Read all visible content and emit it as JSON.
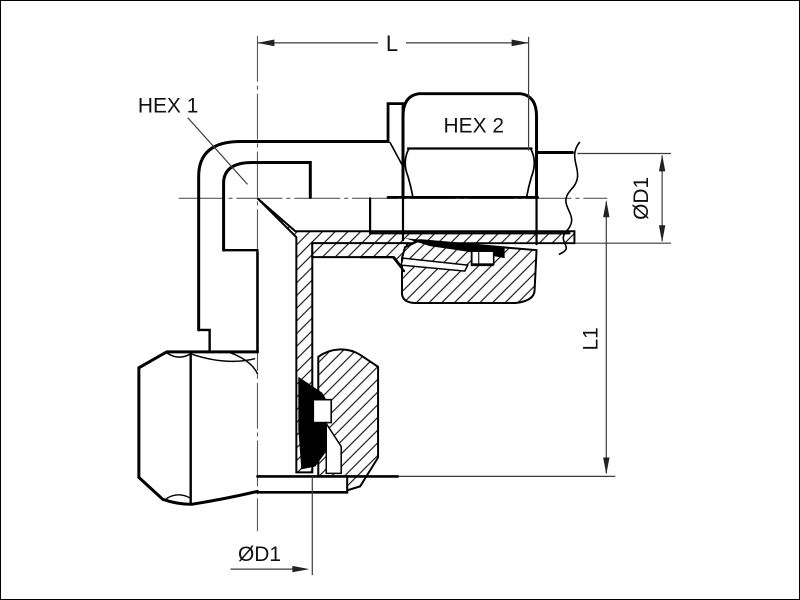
{
  "drawing": {
    "type": "technical-section-drawing",
    "subject": "90-degree elbow compression fitting",
    "background_color": "#ffffff",
    "line_color": "#000000",
    "hatch_color": "#141414",
    "labels": {
      "hex1": "HEX 1",
      "hex2": "HEX 2"
    },
    "dimensions": {
      "length_top": "L",
      "diameter_right": "ØD1",
      "length_right": "L1",
      "diameter_bottom": "ØD1"
    }
  }
}
